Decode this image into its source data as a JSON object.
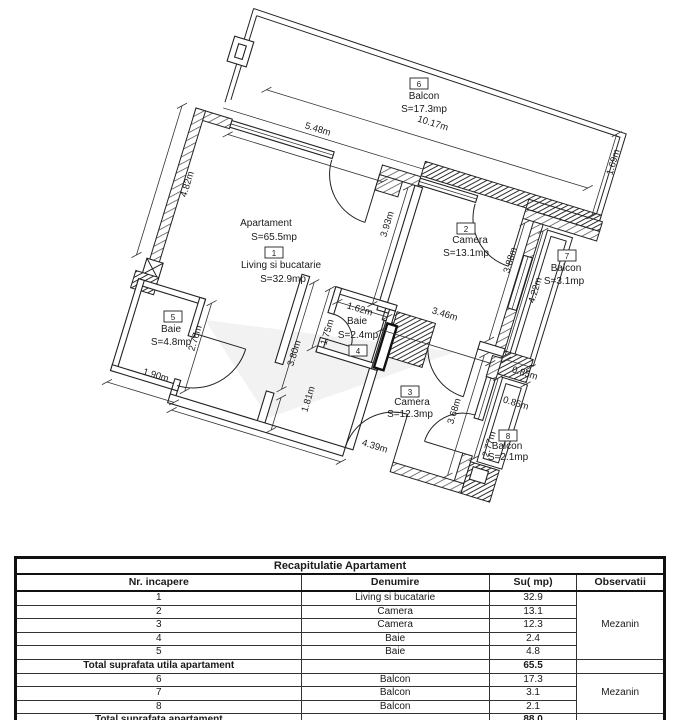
{
  "plan": {
    "apartment_label": {
      "line1": "Apartament",
      "line2": "S=65.5mp",
      "room_number": "1",
      "line3": "Living si bucatarie",
      "line4": "S=32.9mp",
      "pos": {
        "line1": [
          266,
          226
        ],
        "line2": [
          274,
          240
        ],
        "num": [
          274,
          253
        ],
        "line3": [
          281,
          268
        ],
        "line4": [
          283,
          282
        ]
      }
    },
    "rooms": [
      {
        "number": "6",
        "name": "Balcon",
        "area": "S=17.3mp",
        "number_pos": [
          419,
          84
        ],
        "name_pos": [
          424,
          99
        ],
        "area_pos": [
          424,
          112
        ]
      },
      {
        "number": "2",
        "name": "Camera",
        "area": "S=13.1mp",
        "number_pos": [
          466,
          229
        ],
        "name_pos": [
          470,
          243
        ],
        "area_pos": [
          466,
          256
        ]
      },
      {
        "number": "7",
        "name": "Balcon",
        "area": "S=3.1mp",
        "number_pos": [
          567,
          256
        ],
        "name_pos": [
          566,
          271
        ],
        "area_pos": [
          564,
          284
        ]
      },
      {
        "number": "5",
        "name": "Baie",
        "area": "S=4.8mp",
        "number_pos": [
          173,
          317
        ],
        "name_pos": [
          171,
          332
        ],
        "area_pos": [
          171,
          345
        ]
      },
      {
        "number": "4",
        "name": "Baie",
        "area": "S=2.4mp",
        "number_pos": [
          358,
          351
        ],
        "name_pos": [
          357,
          324
        ],
        "area_pos": [
          358,
          338
        ]
      },
      {
        "number": "3",
        "name": "Camera",
        "area": "S=12.3mp",
        "number_pos": [
          410,
          392
        ],
        "name_pos": [
          412,
          405
        ],
        "area_pos": [
          410,
          417
        ]
      },
      {
        "number": "8",
        "name": "Balcon",
        "area": "S=2.1mp",
        "number_pos": [
          508,
          436
        ],
        "name_pos": [
          507,
          449
        ],
        "area_pos": [
          508,
          460
        ]
      }
    ],
    "dimensions": [
      {
        "label": "10.17m",
        "line": [
          62,
          -38,
          398,
          -38
        ],
        "pos": [
          432,
          126
        ],
        "rot": 17
      },
      {
        "label": "5.48m",
        "line": [
          38,
          16,
          200,
          16
        ],
        "pos": [
          317,
          132
        ],
        "rot": 17
      },
      {
        "label": "4.82m",
        "line": [
          -14,
          2,
          -14,
          158
        ],
        "pos": [
          190,
          185
        ],
        "rot": -73
      },
      {
        "label": "3.93m",
        "line": [
          226,
          14,
          226,
          136
        ],
        "pos": [
          390,
          225
        ],
        "rot": -73
      },
      {
        "label": "3.88m",
        "line": [
          348,
          14,
          348,
          136
        ],
        "pos": [
          513,
          261
        ],
        "rot": -73
      },
      {
        "label": "1.69m",
        "line": [
          410,
          -98,
          410,
          -12
        ],
        "pos": [
          616,
          163
        ],
        "rot": -73
      },
      {
        "label": "4.22m",
        "line": [
          368,
          16,
          368,
          146
        ],
        "pos": [
          538,
          291
        ],
        "rot": -73
      },
      {
        "label": "3.46m",
        "line": [
          242,
          158,
          356,
          158
        ],
        "pos": [
          444,
          317
        ],
        "rot": 17
      },
      {
        "label": "1.62m",
        "line": [
          192,
          144,
          244,
          144
        ],
        "pos": [
          359,
          312
        ],
        "rot": 17
      },
      {
        "label": "1.75m",
        "line": [
          181,
          134,
          181,
          196
        ],
        "pos": [
          330,
          333
        ],
        "rot": -73
      },
      {
        "label": "3.80m",
        "line": [
          164,
          132,
          164,
          244
        ],
        "pos": [
          297,
          354
        ],
        "rot": -73
      },
      {
        "label": "1.81m",
        "line": [
          166,
          252,
          166,
          286
        ],
        "pos": [
          311,
          400
        ],
        "rot": -73
      },
      {
        "label": "2.76m",
        "line": [
          72,
          182,
          72,
          274
        ],
        "pos": [
          198,
          339
        ],
        "rot": -73
      },
      {
        "label": "1.90m",
        "line": [
          -5,
          288,
          65,
          288
        ],
        "pos": [
          155,
          378
        ],
        "rot": 17
      },
      {
        "label": "4.39m",
        "line": [
          65,
          296,
          242,
          296
        ],
        "pos": [
          374,
          449
        ],
        "rot": 17
      },
      {
        "label": "3.68m",
        "line": [
          348,
          152,
          348,
          278
        ],
        "pos": [
          457,
          412
        ],
        "rot": -73
      },
      {
        "label": "2.77m",
        "line": [
          368,
          170,
          368,
          254
        ],
        "pos": [
          492,
          445
        ],
        "rot": -73
      },
      {
        "label": "0.85m",
        "line": [
          370,
          150,
          396,
          150
        ],
        "pos": [
          524,
          376
        ],
        "rot": 17
      },
      {
        "label": "0.85m",
        "line": [
          370,
          168,
          396,
          168
        ],
        "pos": [
          515,
          406
        ],
        "rot": 17
      }
    ]
  },
  "table": {
    "title": "Recapitulatie Apartament",
    "columns": [
      "Nr. incapere",
      "Denumire",
      "Su( mp)",
      "Observatii"
    ],
    "rows": [
      {
        "nr": "1",
        "denumire": "Living si bucatarie",
        "su": "32.9"
      },
      {
        "nr": "2",
        "denumire": "Camera",
        "su": "13.1"
      },
      {
        "nr": "3",
        "denumire": "Camera",
        "su": "12.3"
      },
      {
        "nr": "4",
        "denumire": "Baie",
        "su": "2.4"
      },
      {
        "nr": "5",
        "denumire": "Baie",
        "su": "4.8"
      }
    ],
    "subtotal": {
      "label": "Total suprafata utila apartament",
      "su": "65.5"
    },
    "rows2": [
      {
        "nr": "6",
        "denumire": "Balcon",
        "su": "17.3"
      },
      {
        "nr": "7",
        "denumire": "Balcon",
        "su": "3.1"
      },
      {
        "nr": "8",
        "denumire": "Balcon",
        "su": "2.1"
      }
    ],
    "total": {
      "label": "Total suprafata apartament",
      "su": "88.0"
    },
    "observatii_1": "Mezanin",
    "observatii_2": "Mezanin"
  }
}
